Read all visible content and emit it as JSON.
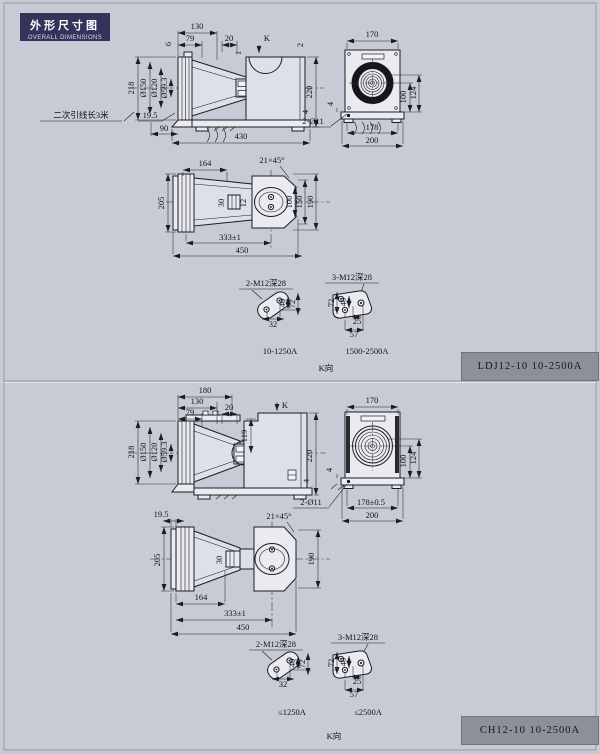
{
  "header": {
    "title_zh": "外形尺寸图",
    "title_en": "OVERALL DIMENSIONS"
  },
  "colors": {
    "background": "#c7cbd6",
    "line": "#1c1c22",
    "title_bg": "#34335a",
    "label_bg": "#8d909a"
  },
  "panel1": {
    "model": "LDJ12-10  10-2500A",
    "front": {
      "d130": "130",
      "d79": "79",
      "d6": "6",
      "d20": "20",
      "k": "K",
      "d2": "2",
      "d1": "1",
      "d218": "218",
      "dia150": "Ø150",
      "dia120": "Ø120",
      "dia59": "Ø59.3",
      "d220": "220",
      "d4": "4",
      "note": "二次引线长3米",
      "d19_5": "19.5",
      "d90": "90",
      "d430": "430"
    },
    "kview": {
      "d170": "170",
      "d100": "100",
      "d124": "124",
      "d4": "4",
      "hole": "2-Ø11",
      "d178": "178",
      "d200": "200"
    },
    "plan": {
      "d164": "164",
      "chamfer": "21×45°",
      "d205": "205",
      "d30": "30",
      "d12": "12",
      "d100": "100",
      "d150": "150",
      "d190": "190",
      "d333": "333±1",
      "d450": "450"
    },
    "detail_a": {
      "title": "2-M12深28",
      "d40": "40",
      "d72": "72",
      "d32": "32",
      "range": "10-1250A"
    },
    "detail_b": {
      "title": "3-M12深28",
      "d72": "72",
      "d40": "40",
      "d25": "25",
      "d57": "57",
      "range": "1500-2500A"
    },
    "kdir": "K向"
  },
  "panel2": {
    "model": "CH12-10  10-2500A",
    "front": {
      "d180": "180",
      "d130": "130",
      "d79": "79",
      "d20": "20",
      "k": "K",
      "d119": "119",
      "d218": "218",
      "dia150": "Ø150",
      "dia120": "Ø120",
      "dia59": "Ø59.3",
      "d220": "220",
      "d4": "4"
    },
    "kview": {
      "d170": "170",
      "d100": "100",
      "d124": "124",
      "d4": "4",
      "hole": "2-Ø11",
      "d178": "178±0.5",
      "d200": "200"
    },
    "plan": {
      "d19_5": "19.5",
      "chamfer": "21×45°",
      "d205": "205",
      "d30": "30",
      "d190": "190",
      "d164": "164",
      "d333": "333±1",
      "d450": "450"
    },
    "detail_a": {
      "title": "2-M12深28",
      "d40": "40",
      "d72": "72",
      "d32": "32",
      "range": "≤1250A"
    },
    "detail_b": {
      "title": "3-M12深28",
      "d72": "72",
      "d40": "40",
      "d25": "25",
      "d57": "57",
      "range": "≤2500A"
    },
    "kdir": "K向"
  }
}
